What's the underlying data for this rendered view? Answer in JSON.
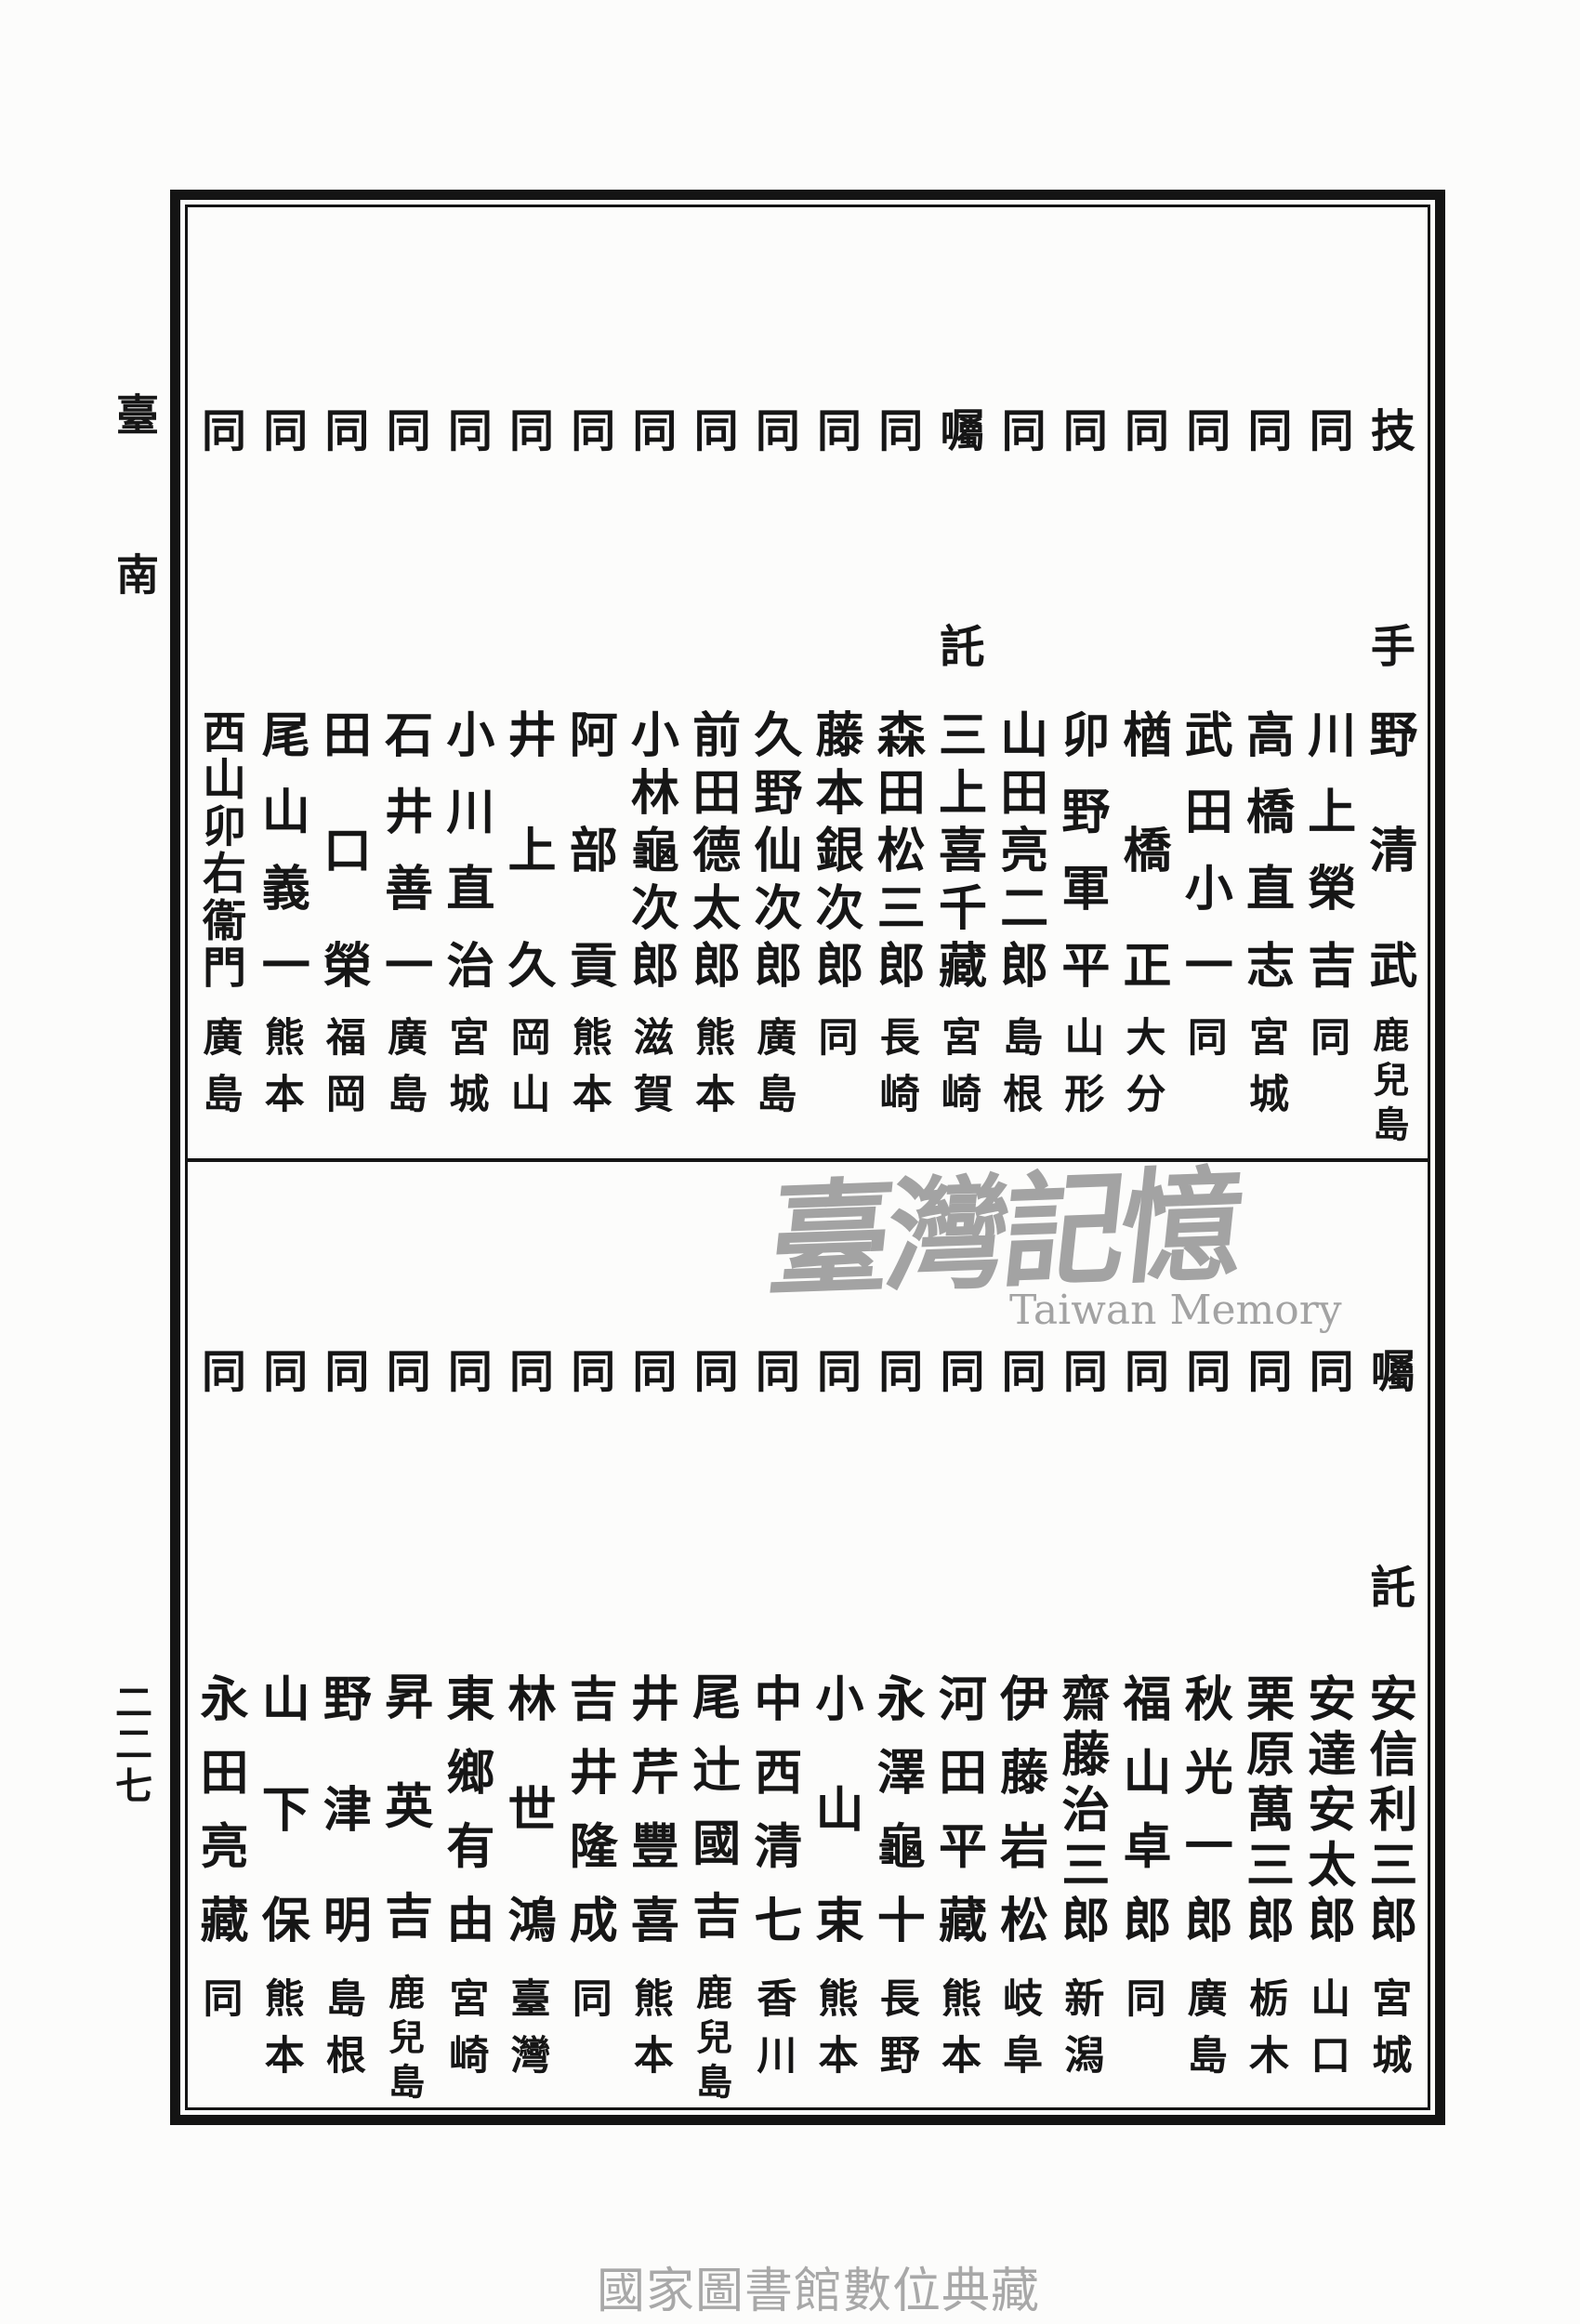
{
  "page": {
    "margin_label": "臺南",
    "page_number": "二二七",
    "ink_color": "#161616",
    "watermark": {
      "cjk": "臺灣記憶",
      "latin": "Taiwan Memory",
      "color": "#a3a3a3"
    },
    "footer_caption": {
      "text": "國家圖書館數位典藏",
      "color": "#a8a8a8"
    }
  },
  "top_section": {
    "columns": [
      {
        "role": "技手",
        "name": "野清武",
        "origin": "鹿兒島"
      },
      {
        "role": "同",
        "name": "川上榮吉",
        "origin": "同"
      },
      {
        "role": "同",
        "name": "高橋直志",
        "origin": "宮城"
      },
      {
        "role": "同",
        "name": "武田小一",
        "origin": "同"
      },
      {
        "role": "同",
        "name": "楢橋正",
        "origin": "大分"
      },
      {
        "role": "同",
        "name": "卯野軍平",
        "origin": "山形"
      },
      {
        "role": "同",
        "name": "山田亮二郎",
        "origin": "島根"
      },
      {
        "role": "囑託",
        "name": "三上喜千藏",
        "origin": "宮崎"
      },
      {
        "role": "同",
        "name": "森田松三郎",
        "origin": "長崎"
      },
      {
        "role": "同",
        "name": "藤本銀次郎",
        "origin": "同"
      },
      {
        "role": "同",
        "name": "久野仙次郎",
        "origin": "廣島"
      },
      {
        "role": "同",
        "name": "前田德太郎",
        "origin": "熊本"
      },
      {
        "role": "同",
        "name": "小林龜次郎",
        "origin": "滋賀"
      },
      {
        "role": "同",
        "name": "阿部貢",
        "origin": "熊本"
      },
      {
        "role": "同",
        "name": "井上久",
        "origin": "岡山"
      },
      {
        "role": "同",
        "name": "小川直治",
        "origin": "宮城"
      },
      {
        "role": "同",
        "name": "石井善一",
        "origin": "廣島"
      },
      {
        "role": "同",
        "name": "田口榮",
        "origin": "福岡"
      },
      {
        "role": "同",
        "name": "尾山義一",
        "origin": "熊本"
      },
      {
        "role": "同",
        "name": "西山卯右衞門",
        "origin": "廣島"
      }
    ]
  },
  "bottom_section": {
    "columns": [
      {
        "role": "囑託",
        "name": "安信利三郎",
        "origin": "宮城"
      },
      {
        "role": "同",
        "name": "安達安太郎",
        "origin": "山口"
      },
      {
        "role": "同",
        "name": "栗原萬三郎",
        "origin": "栃木"
      },
      {
        "role": "同",
        "name": "秋光一郎",
        "origin": "廣島"
      },
      {
        "role": "同",
        "name": "福山卓郎",
        "origin": "同"
      },
      {
        "role": "同",
        "name": "齋藤治三郎",
        "origin": "新潟"
      },
      {
        "role": "同",
        "name": "伊藤岩松",
        "origin": "岐阜"
      },
      {
        "role": "同",
        "name": "河田平藏",
        "origin": "熊本"
      },
      {
        "role": "同",
        "name": "永澤龜十",
        "origin": "長野"
      },
      {
        "role": "同",
        "name": "小山束",
        "origin": "熊本"
      },
      {
        "role": "同",
        "name": "中西清七",
        "origin": "香川"
      },
      {
        "role": "同",
        "name": "尾辻國吉",
        "origin": "鹿兒島"
      },
      {
        "role": "同",
        "name": "井芹豐喜",
        "origin": "熊本"
      },
      {
        "role": "同",
        "name": "吉井隆成",
        "origin": "同"
      },
      {
        "role": "同",
        "name": "林世鴻",
        "origin": "臺灣"
      },
      {
        "role": "同",
        "name": "東鄉有由",
        "origin": "宮崎"
      },
      {
        "role": "同",
        "name": "昇英吉",
        "origin": "鹿兒島"
      },
      {
        "role": "同",
        "name": "野津明",
        "origin": "島根"
      },
      {
        "role": "同",
        "name": "山下保",
        "origin": "熊本"
      },
      {
        "role": "同",
        "name": "永田亮藏",
        "origin": "同"
      }
    ]
  }
}
